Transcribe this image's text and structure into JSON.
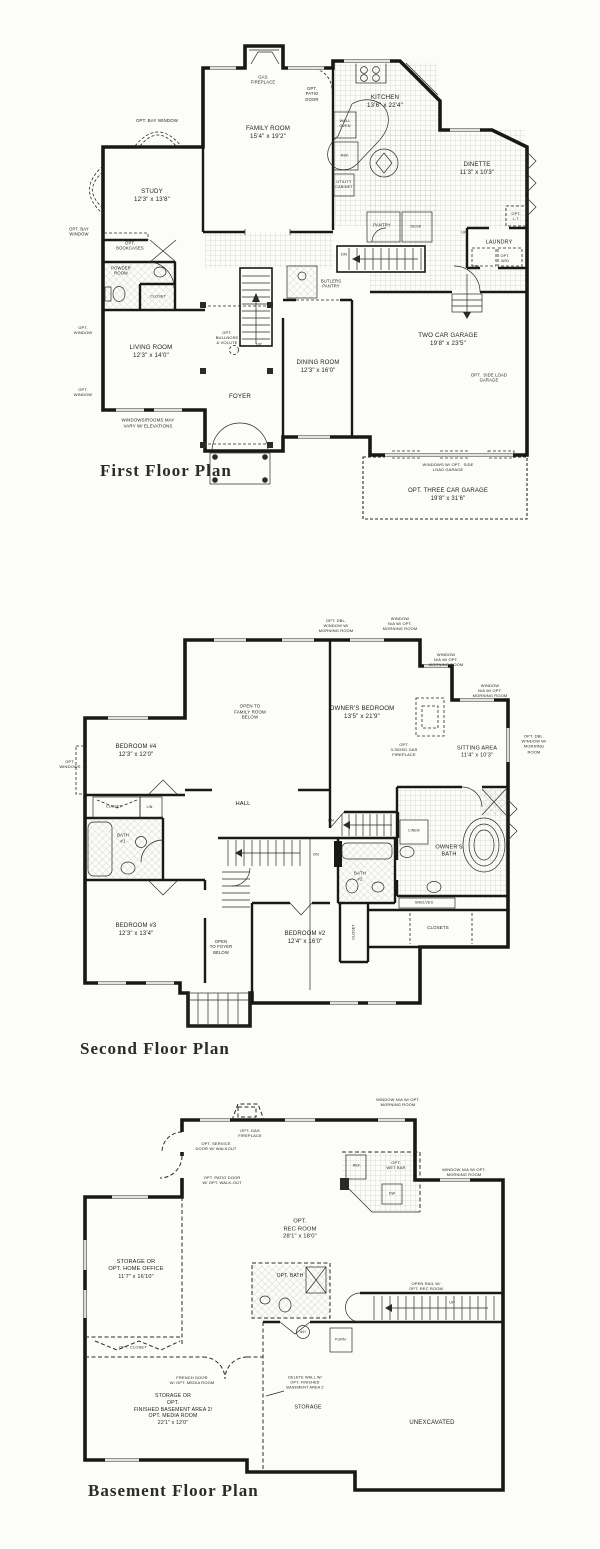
{
  "document": {
    "kind": "residential floor plan sheet",
    "ink_color": "#1e1e1e",
    "paper_color": "#fcfcf9",
    "plans": [
      "First Floor Plan",
      "Second Floor Plan",
      "Basement Floor Plan"
    ]
  },
  "labels": [
    {
      "n": "gas-fireplace-label",
      "t": "GAS\nFIREPLACE",
      "x": 263,
      "y": 80,
      "s": 4.2
    },
    {
      "n": "opt-patio-door-label",
      "t": "OPT.\nPATIO\nDOOR",
      "x": 312,
      "y": 94,
      "s": 4.2
    },
    {
      "n": "family-room-label",
      "t": "FAMILY ROOM\n15'4\" x 19'2\"",
      "x": 268,
      "y": 133,
      "s": 6.2
    },
    {
      "n": "kitchen-label",
      "t": "KITCHEN\n13'6\" x 22'4\"",
      "x": 385,
      "y": 102,
      "s": 6.2
    },
    {
      "n": "wall-oven-label",
      "t": "WALL\nOVEN",
      "x": 345,
      "y": 124,
      "s": 3.8
    },
    {
      "n": "ref-label",
      "t": "REF.",
      "x": 345,
      "y": 156,
      "s": 3.8
    },
    {
      "n": "utility-cabinet-label",
      "t": "UTILITY\nCABINET",
      "x": 344,
      "y": 185,
      "s": 3.8
    },
    {
      "n": "dinette-label",
      "t": "DINETTE\n11'3\" x 10'3\"",
      "x": 477,
      "y": 170,
      "s": 6
    },
    {
      "n": "opt-bay-window-top-label",
      "t": "OPT. BAY WINDOW",
      "x": 157,
      "y": 121,
      "s": 4.4
    },
    {
      "n": "study-label",
      "t": "STUDY\n12'3\" x 13'8\"",
      "x": 152,
      "y": 196,
      "s": 6.2
    },
    {
      "n": "opt-bay-window-left-label",
      "t": "OPT. BAY\nWINDOW",
      "x": 79,
      "y": 232,
      "s": 4.2
    },
    {
      "n": "opt-bookcases-label",
      "t": "OPT.\nBOOKCASES",
      "x": 130,
      "y": 246,
      "s": 4.2
    },
    {
      "n": "powder-room-label",
      "t": "POWDER\nROOM",
      "x": 121,
      "y": 271,
      "s": 4.2
    },
    {
      "n": "closet-f1-label",
      "t": "CLOSET",
      "x": 158,
      "y": 297,
      "s": 3.8
    },
    {
      "n": "pantry-label",
      "t": "PANTRY",
      "x": 382,
      "y": 225,
      "s": 4.2
    },
    {
      "n": "desk-label",
      "t": "DESK",
      "x": 416,
      "y": 227,
      "s": 3.8
    },
    {
      "n": "opt-lt-label",
      "t": "OPT.\nL.T.",
      "x": 516,
      "y": 217,
      "s": 3.8
    },
    {
      "n": "laundry-label",
      "t": "LAUNDRY",
      "x": 499,
      "y": 243,
      "s": 5.4
    },
    {
      "n": "opt-wd-label",
      "t": "OPT.\nW/D",
      "x": 505,
      "y": 259,
      "s": 3.8
    },
    {
      "n": "dn-basement-label",
      "t": "DN",
      "x": 344,
      "y": 254,
      "s": 4
    },
    {
      "n": "up-hall-label",
      "t": "UP",
      "x": 464,
      "y": 233,
      "s": 3.6
    },
    {
      "n": "dn-garage-label",
      "t": "DN",
      "x": 476,
      "y": 266,
      "s": 4
    },
    {
      "n": "butlers-pantry-label",
      "t": "BUTLERS\nPANTRY",
      "x": 331,
      "y": 284,
      "s": 4.2
    },
    {
      "n": "opt-bullnose-label",
      "t": "OPT.\nBULLNOSE\n& VOLUTE",
      "x": 227,
      "y": 338,
      "s": 4
    },
    {
      "n": "up-stairs-label",
      "t": "UP",
      "x": 259,
      "y": 344,
      "s": 4
    },
    {
      "n": "opt-window-1-label",
      "t": "OPT.\nWINDOW",
      "x": 83,
      "y": 330,
      "s": 4
    },
    {
      "n": "living-room-label",
      "t": "LIVING ROOM\n12'3\" x 14'0\"",
      "x": 151,
      "y": 352,
      "s": 6.2
    },
    {
      "n": "opt-window-2-label",
      "t": "OPT.\nWINDOW",
      "x": 83,
      "y": 392,
      "s": 4
    },
    {
      "n": "foyer-label",
      "t": "FOYER",
      "x": 240,
      "y": 397,
      "s": 6.2
    },
    {
      "n": "dining-room-label",
      "t": "DINING ROOM\n12'3\" x 16'0\"",
      "x": 318,
      "y": 368,
      "s": 6
    },
    {
      "n": "two-car-garage-label",
      "t": "TWO CAR GARAGE\n19'8\" x 23'5\"",
      "x": 448,
      "y": 340,
      "s": 6.2
    },
    {
      "n": "opt-side-load-label",
      "t": "OPT.  SIDE LOAD\nGARAGE",
      "x": 489,
      "y": 378,
      "s": 4.2
    },
    {
      "n": "windows-vary-label",
      "t": "WINDOWS/ROOMS MAY\nVARY W/ ELEVATIONS",
      "x": 148,
      "y": 423,
      "s": 4.4
    },
    {
      "n": "windows-opt-side-label",
      "t": "WINDOWS W/ OPT.  SIDE\nLOAD GARAGE",
      "x": 448,
      "y": 467,
      "s": 4
    },
    {
      "n": "opt-three-car-label",
      "t": "OPT. THREE CAR GARAGE\n19'8\" x 31'6\"",
      "x": 448,
      "y": 496,
      "s": 6
    },
    {
      "n": "first-floor-title",
      "t": "First Floor Plan",
      "x": 100,
      "y": 471,
      "s": 17,
      "k": "title"
    },
    {
      "n": "opt-dbl-window-1-label",
      "t": "OPT. DBL.\nWINDOW W/\nMORNING ROOM",
      "x": 336,
      "y": 626,
      "s": 4
    },
    {
      "n": "window-na-1-label",
      "t": "WINDOW\nN/A W/ OPT.\nMORNING ROOM",
      "x": 400,
      "y": 624,
      "s": 4
    },
    {
      "n": "window-na-2-label",
      "t": "WINDOW\nN/A W/ OPT.\nMORNING ROOM",
      "x": 446,
      "y": 660,
      "s": 4
    },
    {
      "n": "window-na-3-label",
      "t": "WINDOW\nN/A W/ OPT.\nMORNING ROOM",
      "x": 490,
      "y": 691,
      "s": 4
    },
    {
      "n": "opt-dbl-window-2-label",
      "t": "OPT. DBL.\nWINDOW W/\nMORNING\nROOM",
      "x": 534,
      "y": 744,
      "s": 4
    },
    {
      "n": "open-to-family-label",
      "t": "OPEN TO\nFAMILY ROOM\nBELOW",
      "x": 250,
      "y": 712,
      "s": 4.4
    },
    {
      "n": "owners-bedroom-label",
      "t": "OWNER'S BEDROOM\n13'5\" x 21'9\"",
      "x": 362,
      "y": 713,
      "s": 6.2
    },
    {
      "n": "bedroom4-label",
      "t": "BEDROOM #4\n12'3\" x 12'0\"",
      "x": 136,
      "y": 752,
      "s": 6
    },
    {
      "n": "opt-windows-label",
      "t": "OPT.\nWINDOWS",
      "x": 70,
      "y": 764,
      "s": 4
    },
    {
      "n": "opt-3sided-fireplace-label",
      "t": "OPT.\n3-SIDED GAS\nFIREPLACE",
      "x": 404,
      "y": 750,
      "s": 4
    },
    {
      "n": "sitting-area-label",
      "t": "SITTING AREA\n11'4\" x 10'3\"",
      "x": 477,
      "y": 753,
      "s": 5.6
    },
    {
      "n": "hall-label",
      "t": "HALL",
      "x": 243,
      "y": 805,
      "s": 5.8
    },
    {
      "n": "closet-b4-label",
      "t": "CLOSET",
      "x": 114,
      "y": 807,
      "s": 3.8
    },
    {
      "n": "lin-label",
      "t": "LIN.",
      "x": 150,
      "y": 807,
      "s": 3.4
    },
    {
      "n": "bath1-label",
      "t": "BATH\n#1",
      "x": 123,
      "y": 838,
      "s": 4.4
    },
    {
      "n": "dn-backstairs-label",
      "t": "DN",
      "x": 331,
      "y": 821,
      "s": 3.8
    },
    {
      "n": "linen-label",
      "t": "LINEN",
      "x": 414,
      "y": 831,
      "s": 3.6
    },
    {
      "n": "owners-bath-label",
      "t": "OWNER'S\nBATH",
      "x": 449,
      "y": 852,
      "s": 5.6
    },
    {
      "n": "bath2-label",
      "t": "BATH\n#2",
      "x": 360,
      "y": 876,
      "s": 4.4
    },
    {
      "n": "closet-vert-label",
      "t": "CLOSET",
      "x": 354,
      "y": 932,
      "s": 3.6,
      "r": 1
    },
    {
      "n": "shelves-label",
      "t": "SHELVES",
      "x": 424,
      "y": 903,
      "s": 3.8
    },
    {
      "n": "closets-label",
      "t": "CLOSETS",
      "x": 438,
      "y": 928,
      "s": 4.4
    },
    {
      "n": "bedroom3-label",
      "t": "BEDROOM #3\n12'3\" x 13'4\"",
      "x": 136,
      "y": 931,
      "s": 6
    },
    {
      "n": "open-to-foyer-label",
      "t": "OPEN\nTO FOYER\nBELOW",
      "x": 221,
      "y": 947,
      "s": 4.2
    },
    {
      "n": "bedroom2-label",
      "t": "BEDROOM #2\n12'4\" x 16'0\"",
      "x": 305,
      "y": 939,
      "s": 6
    },
    {
      "n": "dn-stairs2-label",
      "t": "DN",
      "x": 316,
      "y": 855,
      "s": 3.8
    },
    {
      "n": "second-floor-title",
      "t": "Second Floor Plan",
      "x": 80,
      "y": 1049,
      "s": 17,
      "k": "title"
    },
    {
      "n": "window-na-b1-label",
      "t": "WINDOW N/A W/ OPT.\nMORNING ROOM",
      "x": 398,
      "y": 1102,
      "s": 4
    },
    {
      "n": "opt-gas-fireplace-b-label",
      "t": "OPT. GAS\nFIREPLACE",
      "x": 250,
      "y": 1133,
      "s": 4
    },
    {
      "n": "opt-service-door-label",
      "t": "OPT. SERVICE\nDOOR W/ WALKOUT",
      "x": 216,
      "y": 1146,
      "s": 4
    },
    {
      "n": "opt-patio-door-b-label",
      "t": "OPT. PATIO DOOR\nW/ OPT. WALK-OUT",
      "x": 222,
      "y": 1180,
      "s": 4
    },
    {
      "n": "ref-b-label",
      "t": "REF.",
      "x": 357,
      "y": 1166,
      "s": 3.6
    },
    {
      "n": "opt-wet-bar-label",
      "t": "OPT.\nWET BAR",
      "x": 396,
      "y": 1165,
      "s": 4
    },
    {
      "n": "dw-label",
      "t": "DW",
      "x": 392,
      "y": 1194,
      "s": 3.6
    },
    {
      "n": "window-na-b2-label",
      "t": "WINDOW N/A W/ OPT.\nMORNING ROOM",
      "x": 464,
      "y": 1172,
      "s": 4
    },
    {
      "n": "opt-rec-room-label",
      "t": "OPT.\nREC ROOM\n28'1\" x 18'0\"",
      "x": 300,
      "y": 1230,
      "s": 5.8
    },
    {
      "n": "storage-home-office-label",
      "t": "STORAGE OR\nOPT. HOME OFFICE\n11'7\" x 16'10\"",
      "x": 136,
      "y": 1270,
      "s": 5.6
    },
    {
      "n": "opt-bath-b-label",
      "t": "OPT. BATH",
      "x": 290,
      "y": 1276,
      "s": 5
    },
    {
      "n": "open-rail-label",
      "t": "OPEN RAIL W/\nOPT. REC ROOM",
      "x": 426,
      "y": 1286,
      "s": 4
    },
    {
      "n": "up-b-label",
      "t": "UP",
      "x": 452,
      "y": 1303,
      "s": 3.6
    },
    {
      "n": "ah-label",
      "t": "A/H",
      "x": 303,
      "y": 1332,
      "s": 3.2
    },
    {
      "n": "furn-label",
      "t": "FURN.",
      "x": 341,
      "y": 1340,
      "s": 3.6
    },
    {
      "n": "opt-closet-b-label",
      "t": "OPT. CLOSET",
      "x": 133,
      "y": 1347,
      "s": 4
    },
    {
      "n": "french-door-label",
      "t": "FRENCH DOOR\nW/ OPT. MEDIA ROOM",
      "x": 192,
      "y": 1380,
      "s": 4
    },
    {
      "n": "delete-wall-label",
      "t": "DELETE WALL W/\nOPT. FINISHED\nBASEMENT AREA 2",
      "x": 305,
      "y": 1383,
      "s": 3.8
    },
    {
      "n": "storage-media-label",
      "t": "STORAGE OR\nOPT.\nFINISHED BASEMENT AREA 2/\nOPT. MEDIA ROOM\n22'1\" x 12'0\"",
      "x": 173,
      "y": 1410,
      "s": 5.2
    },
    {
      "n": "storage-b-label",
      "t": "STORAGE",
      "x": 308,
      "y": 1408,
      "s": 5.4
    },
    {
      "n": "unexcavated-label",
      "t": "UNEXCAVATED",
      "x": 432,
      "y": 1424,
      "s": 6
    },
    {
      "n": "basement-title",
      "t": "Basement Floor Plan",
      "x": 88,
      "y": 1491,
      "s": 17,
      "k": "title"
    }
  ]
}
